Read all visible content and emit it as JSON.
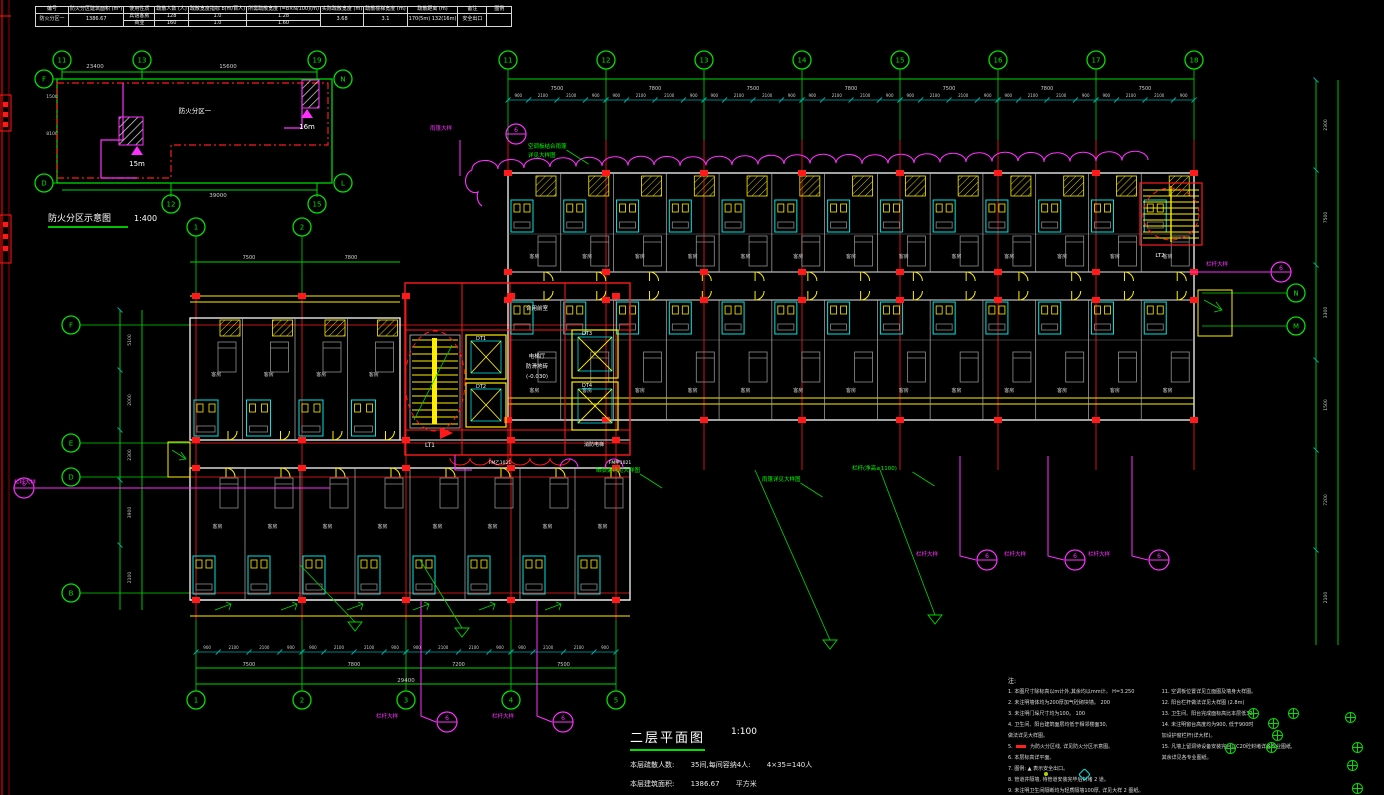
{
  "title_block": {
    "headers": [
      "编号",
      "防火分区建筑面积 (m²)",
      "使用性质",
      "疏散人数 (人)",
      "疏散宽度指标 b(m/百人)",
      "所需疏散宽度 (=b×N/100)(m)",
      "实际疏散宽度 (m)",
      "疏散楼梯宽度 (m)",
      "疏散距离 (m)",
      "备注",
      "图例"
    ],
    "zone_no": "防火分区一",
    "area": "1386.67",
    "rows": [
      {
        "use": "宾馆客房",
        "n": "128",
        "b": "1.0",
        "w": "1.28"
      },
      {
        "use": "商业",
        "n": "160",
        "b": "1.0",
        "w": "1.60"
      }
    ],
    "actual_width": "3.68",
    "stair_width": "3.1",
    "distance": "170(5m) 132(16m)",
    "remark": "安全出口",
    "legend": ""
  },
  "key_plan": {
    "caption": "防火分区示意图",
    "scale": "1:400",
    "zone_label": "防火分区一",
    "dist_left": "15m",
    "dist_right": "16m",
    "dims": {
      "top_left": "23400",
      "top_right": "15600",
      "bottom": "39000",
      "side_upper": "1500",
      "side_lower": "8100"
    },
    "bubbles": {
      "top": [
        "11",
        "13",
        "19"
      ],
      "bottom": [
        "12",
        "15"
      ],
      "left": [
        "F",
        "D"
      ],
      "right": [
        "N",
        "L"
      ]
    }
  },
  "main_plan": {
    "grid": {
      "top": [
        "11",
        "12",
        "13",
        "14",
        "15",
        "16",
        "17",
        "18"
      ],
      "bottom": [
        "1",
        "2",
        "3",
        "4",
        "5"
      ],
      "mid": [
        "1",
        "2"
      ],
      "left": [
        "F",
        "E",
        "D",
        "B"
      ],
      "right": [
        "N",
        "M"
      ]
    },
    "dims": {
      "top_major": [
        "7500",
        "7800",
        "7500",
        "7800",
        "7500",
        "7800",
        "7500"
      ],
      "small": [
        "900",
        "2100",
        "2100",
        "900"
      ],
      "bottom_major": [
        "7500",
        "7800",
        "7200",
        "7500"
      ],
      "bottom_total": "29400",
      "mid_major": [
        "7500",
        "7800"
      ],
      "left": [
        "5100",
        "2000",
        "2300",
        "3900",
        "2100"
      ],
      "right": [
        "2300",
        "7500",
        "3300",
        "1500",
        "7200",
        "2100"
      ]
    },
    "rooms": {
      "guest": "客房",
      "stair1": "LT1",
      "stair2": "LT2",
      "lift1": "DT1",
      "lift2": "DT2",
      "lift3": "DT3",
      "lift4": "DT4",
      "lobby": [
        "电梯厅",
        "防滑地砖",
        "(-0.030)"
      ],
      "front_room": "合用前室",
      "fire_lift": "消防电梯"
    },
    "door_codes": [
      "FM乙1021",
      "FM甲1021"
    ],
    "annotations": [
      {
        "x": 528,
        "y": 148,
        "lines": [
          "空调板结合雨篷",
          "详见大样图"
        ]
      },
      {
        "x": 596,
        "y": 472,
        "lines": [
          "晒衣架详见大样图"
        ]
      },
      {
        "x": 762,
        "y": 481,
        "lines": [
          "雨篷详见大样图"
        ]
      },
      {
        "x": 852,
        "y": 470,
        "lines": [
          "栏杆(净高≥1100)"
        ]
      }
    ],
    "callouts": [
      {
        "label": "栏杆大样",
        "num": "6",
        "cx": 24,
        "cy": 488,
        "lx": 36,
        "ly": 484,
        "leader": [
          [
            35,
            488
          ],
          [
            330,
            488
          ]
        ]
      },
      {
        "label": "雨篷大样",
        "num": "6",
        "cx": 516,
        "cy": 134,
        "lx": 452,
        "ly": 130,
        "leader": [
          [
            460,
            140
          ],
          [
            460,
            176
          ]
        ]
      },
      {
        "label": "栏杆大样",
        "num": "6",
        "cx": 447,
        "cy": 722,
        "lx": 398,
        "ly": 718,
        "leader": [
          [
            421,
            600
          ],
          [
            421,
            716
          ],
          [
            436,
            722
          ]
        ]
      },
      {
        "label": "栏杆大样",
        "num": "6",
        "cx": 563,
        "cy": 722,
        "lx": 514,
        "ly": 718,
        "leader": [
          [
            537,
            600
          ],
          [
            537,
            716
          ],
          [
            552,
            722
          ]
        ]
      },
      {
        "label": "栏杆大样",
        "num": "6",
        "cx": 987,
        "cy": 560,
        "lx": 938,
        "ly": 556,
        "leader": [
          [
            960,
            456
          ],
          [
            960,
            556
          ],
          [
            976,
            560
          ]
        ]
      },
      {
        "label": "栏杆大样",
        "num": "6",
        "cx": 1075,
        "cy": 560,
        "lx": 1026,
        "ly": 556,
        "leader": [
          [
            1048,
            456
          ],
          [
            1048,
            556
          ],
          [
            1064,
            560
          ]
        ]
      },
      {
        "label": "栏杆大样",
        "num": "6",
        "cx": 1159,
        "cy": 560,
        "lx": 1110,
        "ly": 556,
        "leader": [
          [
            1132,
            456
          ],
          [
            1132,
            556
          ],
          [
            1148,
            560
          ]
        ]
      },
      {
        "label": "栏杆大样",
        "num": "6",
        "cx": 1281,
        "cy": 272,
        "lx": 1228,
        "ly": 266,
        "leader": [
          [
            1190,
            272
          ],
          [
            1270,
            272
          ]
        ]
      }
    ]
  },
  "sheet_title": {
    "title": "二层平面图",
    "scale": "1:100",
    "line1_label": "本层疏散人数:",
    "line1_mid": "35间,每间容纳4人:",
    "line1_val": "4×35=140人",
    "line2_label": "本层建筑面积:",
    "line2_val": "1386.67",
    "line2_unit": "平方米"
  },
  "notes": {
    "heading": "注:",
    "left": [
      "1. 本图尺寸除标高以m计外,其余均以mm计。        H=3.250",
      "2. 未注明墙体均为200厚加气砼砌块墙。            200",
      "3. 未注明门垛尺寸均为100。                      100",
      "4. 卫生间、阳台建筑面层均低于相邻楼面30,",
      "    做法详见大样图。",
      "5. ■ 为防火分区线, 详见防火分区示意图。",
      "6. 本层标高详平面。",
      "7. 图例:  ▲ 表示安全出口。",
      "8. 管道井隔墙, 待管道安装完毕后封堵 2 道。",
      "9. 未注明卫生间隔断均为轻质隔墙100厚, 详见大样 2 图纸。"
    ],
    "right": [
      "11. 空调板位置详见立面图及墙身大样图。",
      "12. 阳台栏杆做法详见大样图 (2.8m)",
      "13. 卫生间、阳台完成面标高比本层低30。",
      "14. 未注明窗台高度均为900, 低于900时",
      "     加设护窗栏杆(详大样)。",
      "15. 凡墙上留洞待设备安装完后以C20砼封堵详各专业图纸,",
      "     其余详见各专业图纸。"
    ]
  }
}
